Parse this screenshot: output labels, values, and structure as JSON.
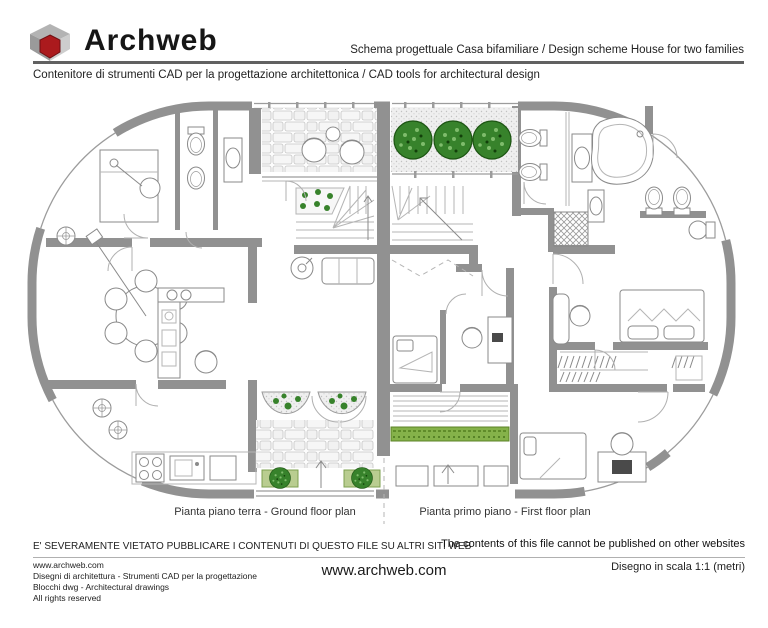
{
  "header": {
    "brand": "Archweb",
    "logo_icon": "archweb-cube",
    "scheme_title": "Schema progettuale Casa bifamiliare  /  Design scheme House for two families",
    "tagline": "Contenitore di strumenti CAD per la progettazione architettonica  /  CAD tools for architectural design"
  },
  "plans": {
    "ground": {
      "caption": "Pianta piano terra - Ground floor plan"
    },
    "first": {
      "caption": "Pianta primo piano - First floor plan"
    }
  },
  "notice": {
    "it": "E' SEVERAMENTE VIETATO PUBBLICARE I CONTENUTI DI QUESTO FILE SU ALTRI SITI WEB",
    "en": "The contents of this file cannot be published on other websites"
  },
  "footer": {
    "left_lines": [
      "www.archweb.com",
      "Disegni di architettura - Strumenti CAD  per la progettazione",
      "Blocchi dwg - Architectural drawings",
      "All rights reserved"
    ],
    "center_site": "www.archweb.com",
    "scale_note": "Disegno in scala 1:1 (metri)"
  },
  "colors": {
    "wall": "#919191",
    "tree": "#37822b",
    "hedge": "#85b24a",
    "planter": "#b9cd90",
    "logo_red": "#ab1a1d"
  }
}
